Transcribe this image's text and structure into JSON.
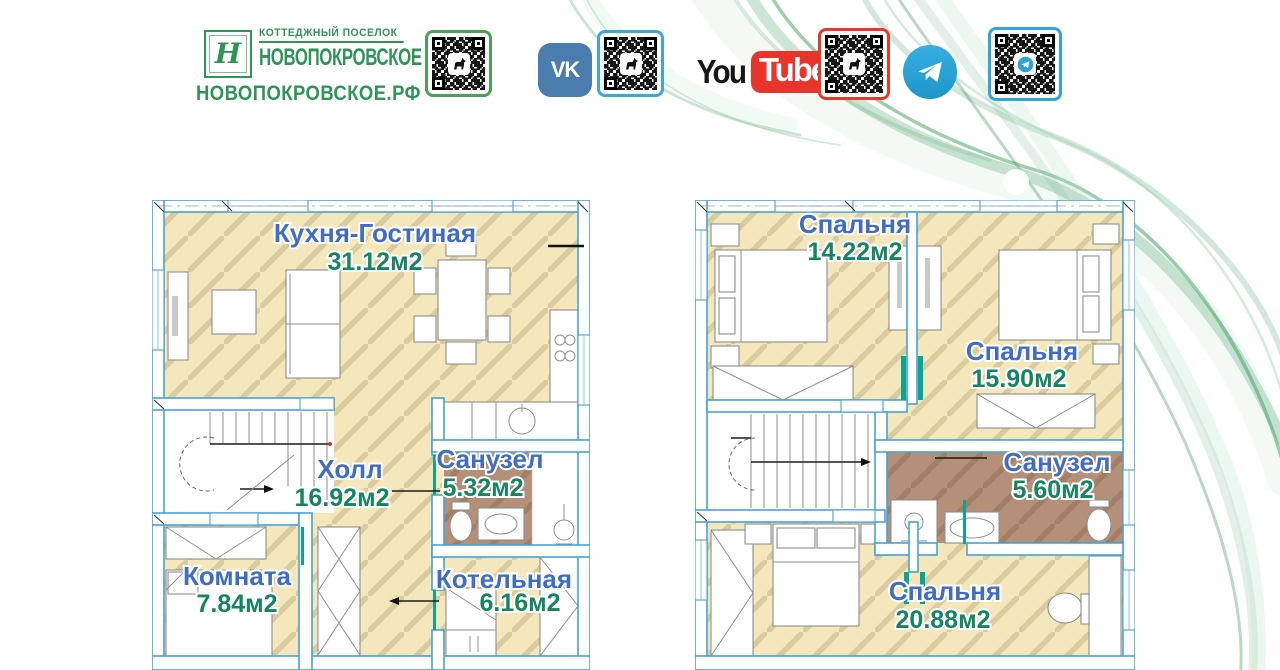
{
  "brand": {
    "monogram": "Н",
    "tagline": "КОТТЕДЖНЫЙ ПОСЕЛОК",
    "name": "НОВОПОКРОВСКОЕ",
    "website": "НОВОПОКРОВСКОЕ.РФ"
  },
  "social": {
    "vk": "VK",
    "youtube_you": "You",
    "youtube_tube": "Tube"
  },
  "colors": {
    "brand_green": "#2e9556",
    "qr_green_border": "#4d9e57",
    "qr_blue_border": "#3aa7dc",
    "qr_red_border": "#e23b2e",
    "vk_blue": "#4b7cae",
    "youtube_red": "#e8342a",
    "telegram_blue": "#2ba3d8",
    "wall_blue": "#44a3da",
    "floor_beige": "#f4e7bc",
    "floor_hatch": "#d9cb9e",
    "bathroom_brown": "#b49079",
    "room_label_blue": "#3f6cc5",
    "room_area_green": "#14855f",
    "door_teal": "#0aa396"
  },
  "floor1": {
    "kitchen_living": {
      "name": "Кухня-Гостиная",
      "area": "31.12м2"
    },
    "hall": {
      "name": "Холл",
      "area": "16.92м2"
    },
    "bathroom": {
      "name": "Санузел",
      "area": "5.32м2"
    },
    "room": {
      "name": "Комната",
      "area": "7.84м2"
    },
    "boiler": {
      "name": "Котельная",
      "area": "6.16м2"
    }
  },
  "floor2": {
    "bedroom1": {
      "name": "Спальня",
      "area": "14.22м2"
    },
    "bedroom2": {
      "name": "Спальня",
      "area": "15.90м2"
    },
    "bathroom": {
      "name": "Санузел",
      "area": "5.60м2"
    },
    "bedroom3": {
      "name": "Спальня",
      "area": "20.88м2"
    }
  }
}
